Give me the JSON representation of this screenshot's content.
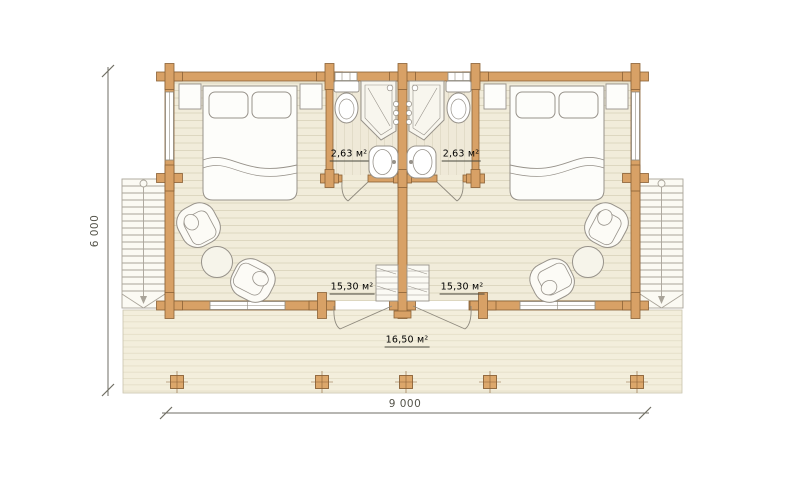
{
  "plan": {
    "type": "duplex-cabin-floor-plan",
    "rooms": {
      "bathroom_left_area": "2,63 м²",
      "bathroom_right_area": "2,63 м²",
      "bedroom_left_area": "15,30 м²",
      "bedroom_right_area": "15,30 м²",
      "terrace_area": "16,50 м²"
    },
    "dimensions": {
      "overall_depth": "6 000",
      "overall_width": "9 000"
    },
    "colors": {
      "log_wall": "#d8a166",
      "wall_outline": "#8a6136",
      "bedroom_floor": "#f1ecda",
      "terrace_floor": "#f3eedc",
      "furniture_line": "#97928a",
      "dimension_line": "#6f6e64",
      "background": "#ffffff"
    }
  }
}
